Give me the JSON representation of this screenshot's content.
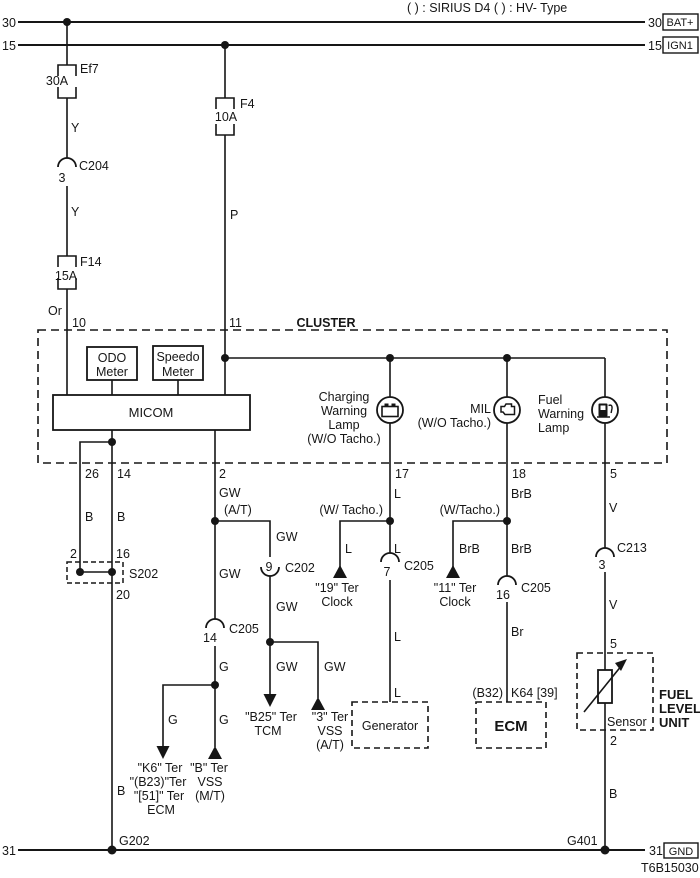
{
  "header": {
    "note": "( ) : SIRIUS D4  (  ) : HV- Type",
    "rails": {
      "r30": {
        "left": "30",
        "right": "30",
        "tag": "BAT+"
      },
      "r15": {
        "left": "15",
        "right": "15",
        "tag": "IGN1"
      }
    }
  },
  "fuses": {
    "ef7": {
      "name": "Ef7",
      "rating": "30A"
    },
    "f4": {
      "name": "F4",
      "rating": "10A"
    },
    "f14": {
      "name": "F14",
      "rating": "15A"
    }
  },
  "connectors": {
    "c204": {
      "pin": "3",
      "name": "C204"
    },
    "c202": {
      "pin": "9",
      "name": "C202"
    },
    "c205a": {
      "pin": "14",
      "name": "C205"
    },
    "c205b": {
      "pin": "7",
      "name": "C205"
    },
    "c205c": {
      "pin": "16",
      "name": "C205"
    },
    "c213": {
      "pin": "3",
      "name": "C213"
    },
    "s202": {
      "name": "S202",
      "pin_left": "2",
      "pin_right": "16",
      "pin_out": "20"
    }
  },
  "cluster": {
    "title": "CLUSTER",
    "odo": [
      "ODO",
      "Meter"
    ],
    "speedo": [
      "Speedo",
      "Meter"
    ],
    "micom": "MICOM",
    "pins": {
      "p10": "10",
      "p11": "11",
      "p26": "26",
      "p14": "14",
      "p2": "2",
      "p17": "17",
      "p18": "18",
      "p5": "5"
    },
    "charging_lamp": [
      "Charging",
      "Warning",
      "Lamp",
      "(W/O Tacho.)"
    ],
    "mil_lamp": [
      "MIL",
      "(W/O Tacho.)"
    ],
    "fuel_lamp": [
      "Fuel",
      "Warning",
      "Lamp"
    ]
  },
  "wires": {
    "y1": "Y",
    "y2": "Y",
    "or1": "Or",
    "p1": "P",
    "b1": "B",
    "b2": "B",
    "b3": "B",
    "b4": "B",
    "gw1": "GW",
    "gw_at": "(A/T)",
    "gw2": "GW",
    "gw3": "GW",
    "gw4": "GW",
    "gw5": "GW",
    "gw6": "GW",
    "g1": "G",
    "g2": "G",
    "g3": "G",
    "l1": "L",
    "l2": "L",
    "l3": "L",
    "l4": "L",
    "l5": "L",
    "wt_l": "(W/ Tacho.)",
    "wt_r": "(W/Tacho.)",
    "brb1": "BrB",
    "brb2": "BrB",
    "brb3": "BrB",
    "br1": "Br",
    "v1": "V",
    "v2": "V"
  },
  "terminals": {
    "clock19": [
      "\"19\" Ter",
      "Clock"
    ],
    "clock11": [
      "\"11\" Ter",
      "Clock"
    ],
    "tcm": [
      "\"B25\" Ter",
      "TCM"
    ],
    "vss_at": [
      "\"3\" Ter",
      "VSS",
      "(A/T)"
    ],
    "ecm_mt": [
      "\"K6\" Ter",
      "\"(B23)\"Ter",
      "\"[51]\" Ter",
      "ECM"
    ],
    "vss_mt": [
      "\"B\" Ter",
      "VSS",
      "(M/T)"
    ]
  },
  "boxes": {
    "generator": "Generator",
    "ecm": {
      "ref_left": "(B32)",
      "ref_right": "K64 [39]",
      "label": "ECM"
    },
    "fuel_unit": {
      "pin_top": "5",
      "pin_bottom": "2",
      "sensor": "Sensor",
      "title": [
        "FUEL",
        "LEVEL",
        "UNIT"
      ]
    }
  },
  "ground": {
    "left": "31",
    "right": "31",
    "tag": "GND",
    "g202": "G202",
    "g401": "G401"
  },
  "footer": {
    "code": "T6B15030"
  },
  "colors": {
    "line": "#161616",
    "background": "#ffffff"
  }
}
